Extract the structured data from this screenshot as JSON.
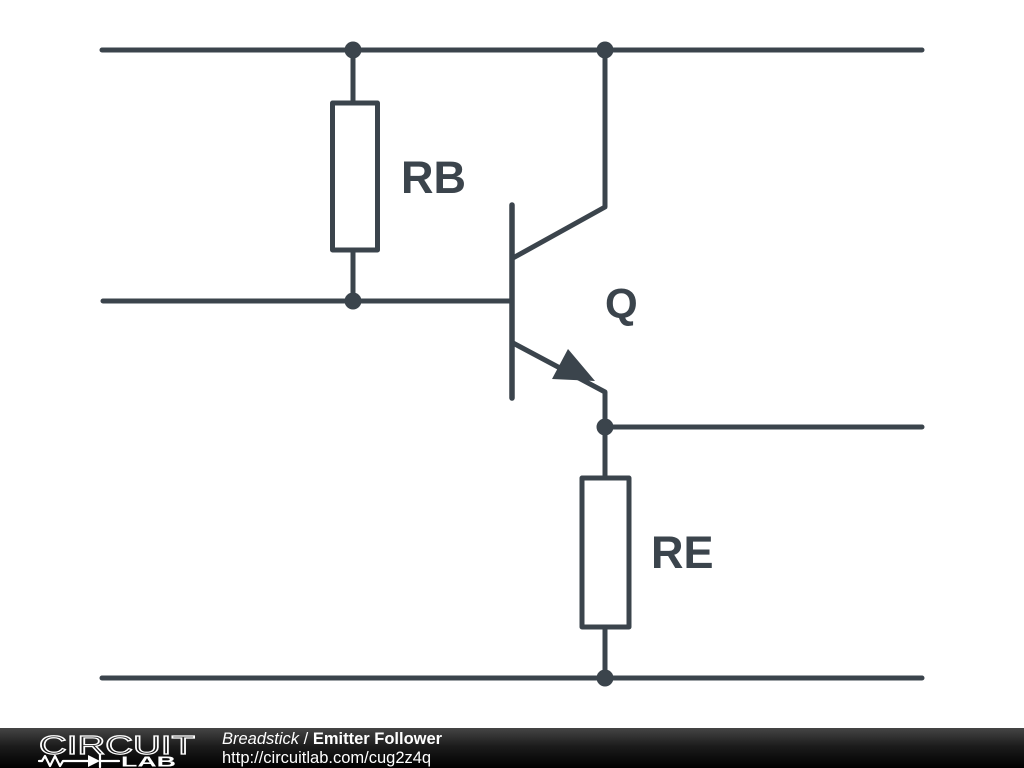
{
  "theme": {
    "stroke": "#3b444c",
    "footer_text": "#ffffff",
    "footer_bg": "#111111",
    "canvas_bg": "#ffffff"
  },
  "diagram": {
    "type": "circuit-schematic",
    "components": [
      {
        "ref": "RB",
        "kind": "resistor",
        "label": "RB"
      },
      {
        "ref": "Q",
        "kind": "npn-transistor",
        "label": "Q"
      },
      {
        "ref": "RE",
        "kind": "resistor",
        "label": "RE"
      }
    ]
  },
  "footer": {
    "logo_word_top": "CIRCUIT",
    "logo_word_bottom": "LAB",
    "author": "Breadstick",
    "separator": "/",
    "title": "Emitter Follower",
    "url": "http://circuitlab.com/cug2z4q"
  }
}
